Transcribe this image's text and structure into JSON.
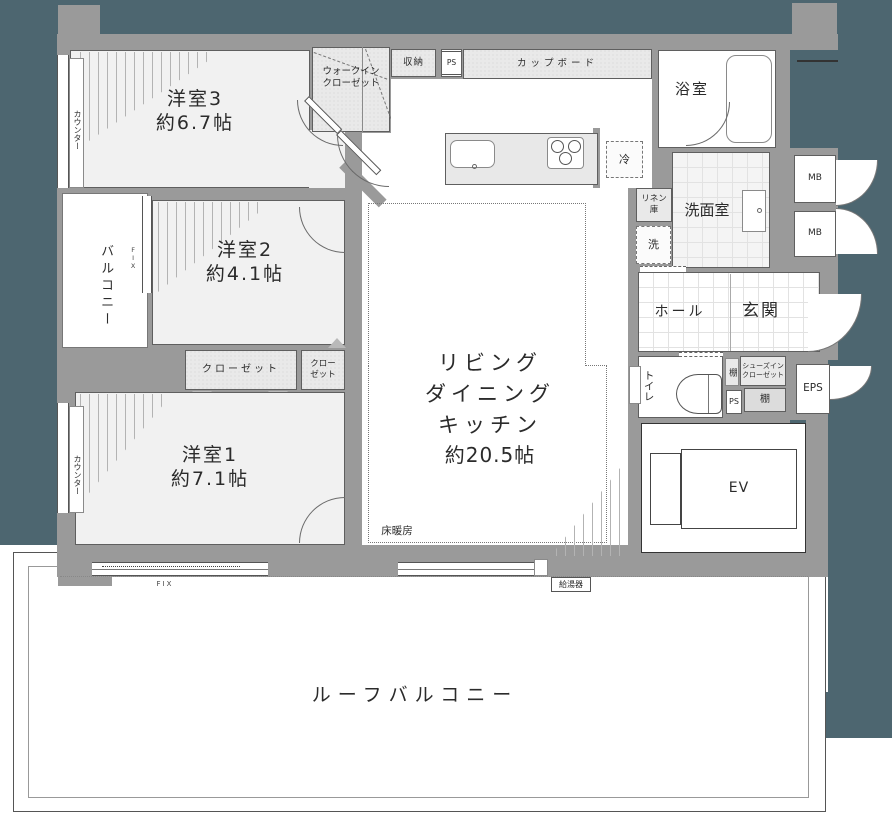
{
  "plan_title": "floor-plan",
  "labels": {
    "room3_name": "洋室3",
    "room3_size": "約6.7帖",
    "room2_name": "洋室2",
    "room2_size": "約4.1帖",
    "room1_name": "洋室1",
    "room1_size": "約7.1帖",
    "ldk_1": "リビング",
    "ldk_2": "ダイニング",
    "ldk_3": "キッチン",
    "ldk_size": "約20.5帖",
    "wic_1": "ウォークイン",
    "wic_2": "クローゼット",
    "shuno": "収納",
    "ps_top": "PS",
    "cupboard": "カップボード",
    "bath": "浴室",
    "fridge": "冷",
    "linen_1": "リネン",
    "linen_2": "庫",
    "washroom": "洗面室",
    "washer": "洗",
    "mb_1": "MB",
    "mb_2": "MB",
    "hall": "ホール",
    "genkan": "玄関",
    "toilet": "トイレ",
    "tana_side": "棚",
    "shoes_1": "シューズイン",
    "shoes_2": "クローゼット",
    "ps_lower": "PS",
    "tana_lower": "棚",
    "eps": "EPS",
    "ev": "EV",
    "water_heater": "給湯器",
    "closet": "クローゼット",
    "closet_s_1": "クロー",
    "closet_s_2": "ゼット",
    "balcony": "バルコニー",
    "counter_top": "カウンター",
    "counter_bottom": "カウンター",
    "fix_side": "FIX",
    "fix_bottom": "FIX",
    "floor_heating": "床暖房",
    "roof_balcony": "ルーフバルコニー"
  },
  "colors": {
    "outside": "#4d6670",
    "wall": "#9a9a9a",
    "room_fill": "#f1f1f1",
    "closet_fill": "#e9e9e9",
    "line": "#5f5f5f"
  }
}
